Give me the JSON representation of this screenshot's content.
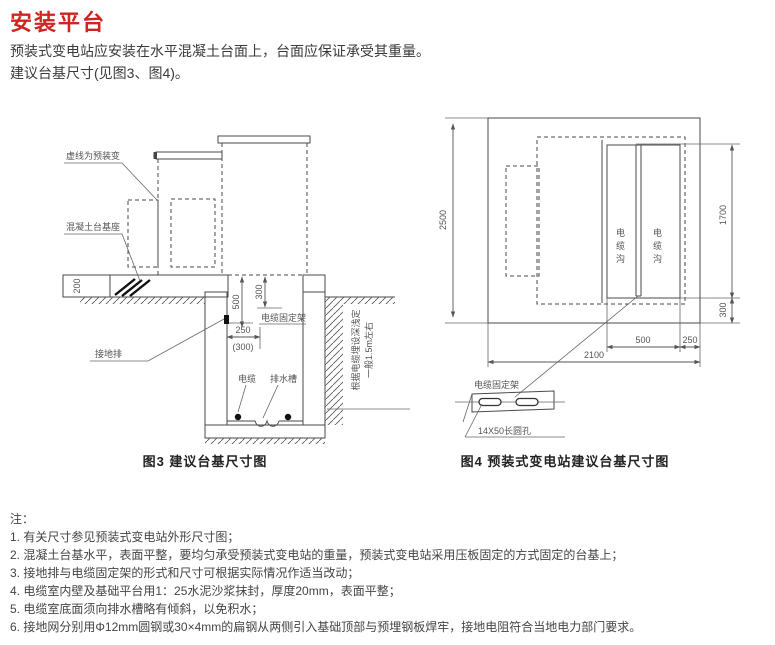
{
  "page": {
    "title": "安装平台",
    "intro1": "预装式变电站应安装在水平混凝土台面上，台面应保证承受其重量。",
    "intro2": "建议台基尺寸(见图3、图4)。"
  },
  "fig3": {
    "caption": "图3 建议台基尺寸图",
    "label_dashed": "虚线为预装变",
    "label_base": "混凝土台基座",
    "label_ground_bar": "接地排",
    "label_bracket": "电缆固定架",
    "label_cable": "电缆",
    "label_drain": "排水槽",
    "note_vertical_1": "一般1.5m左右",
    "note_vertical_2": "根据电缆埋设深浅定",
    "dim_200": "200",
    "dim_500": "500",
    "dim_300": "300",
    "dim_250": "250",
    "dim_300alt": "(300)"
  },
  "fig4": {
    "caption": "图4 预装式变电站建议台基尺寸图",
    "dim_2500": "2500",
    "dim_1700": "1700",
    "dim_300": "300",
    "dim_500": "500",
    "dim_250": "250",
    "dim_2100": "2100",
    "label_trench_left": "电缆沟",
    "label_trench_right": "电缆沟",
    "label_bracket": "电缆固定架",
    "label_slot": "14X50长圆孔"
  },
  "notes": {
    "heading": "注：",
    "items": [
      "1. 有关尺寸参见预装式变电站外形尺寸图；",
      "2. 混凝土台基水平，表面平整，要均匀承受预装式变电站的重量，预装式变电站采用压板固定的方式固定的台基上；",
      "3. 接地排与电缆固定架的形式和尺寸可根据实际情况作适当改动；",
      "4. 电缆室内壁及基础平台用1：25水泥沙浆抹封，厚度20mm，表面平整；",
      "5. 电缆室底面须向排水槽略有倾斜，以免积水；",
      "6. 接地网分别用Φ12mm圆钢或30×4mm的扁钢从两侧引入基础顶部与预埋钢板焊牢，接地电阻符合当地电力部门要求。"
    ]
  }
}
